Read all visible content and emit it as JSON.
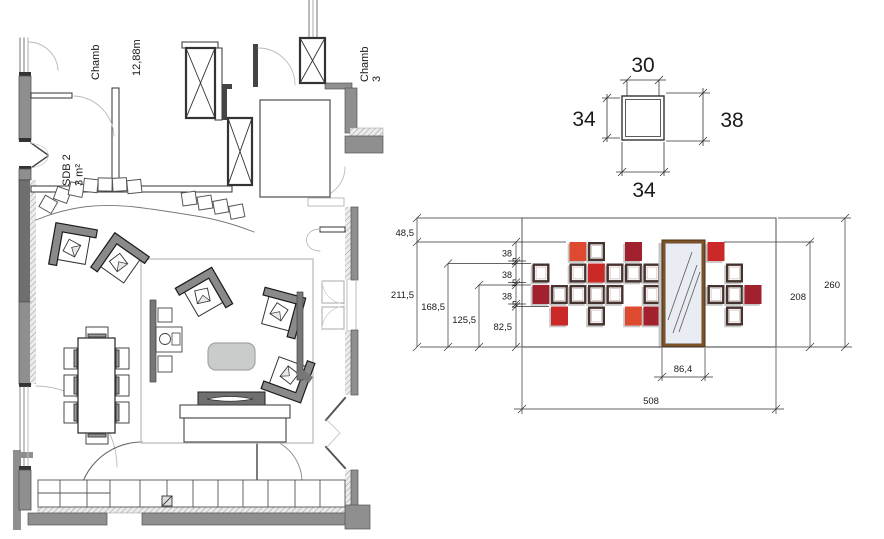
{
  "floor_plan": {
    "labels": {
      "bedroom_left": "Chamb",
      "bedroom_left_area": "12,88m",
      "bathroom": "SDB 2",
      "bathroom_area": "3 m²",
      "bedroom_right": "Chamb",
      "bedroom_right_number": "3"
    }
  },
  "frame_detail": {
    "width_top": "30",
    "height_left": "34",
    "height_right": "38",
    "width_bottom": "34"
  },
  "elevation": {
    "dim_48": "48,5",
    "dim_211": "211,5",
    "dim_168": "168,5",
    "dim_125": "125,5",
    "dim_82": "82,5",
    "stack": [
      {
        "v": "38"
      },
      {
        "v": "5"
      },
      {
        "v": "38"
      },
      {
        "v": "5"
      },
      {
        "v": "38"
      },
      {
        "v": "5"
      }
    ],
    "dim_208": "208",
    "dim_260": "260",
    "dim_mirror": "86,4",
    "dim_total": "508",
    "colors": {
      "orange": "#de4a2f",
      "red": "#ca2928",
      "dark_red": "#a2212f",
      "frame": "#46322f",
      "frame_inner": "#cbb9b3",
      "mirror_wood": "#7d5226",
      "glass": "#e9edf3",
      "shadow": "#c6c6c6"
    },
    "frames": [
      {
        "col": "C",
        "row": 1,
        "fill": "orange"
      },
      {
        "col": "D",
        "row": 1,
        "fill": "white"
      },
      {
        "col": "F",
        "row": 1,
        "fill": "dark_red"
      },
      {
        "col": "H",
        "row": 1,
        "fill": "red"
      },
      {
        "col": "A",
        "row": 2,
        "fill": "white"
      },
      {
        "col": "C",
        "row": 2,
        "fill": "white"
      },
      {
        "col": "D",
        "row": 2,
        "fill": "red"
      },
      {
        "col": "E",
        "row": 2,
        "fill": "white"
      },
      {
        "col": "F",
        "row": 2,
        "fill": "white"
      },
      {
        "col": "G",
        "row": 2,
        "fill": "white"
      },
      {
        "col": "I",
        "row": 2,
        "fill": "white"
      },
      {
        "col": "A",
        "row": 3,
        "fill": "dark_red"
      },
      {
        "col": "B",
        "row": 3,
        "fill": "white"
      },
      {
        "col": "C",
        "row": 3,
        "fill": "white"
      },
      {
        "col": "D",
        "row": 3,
        "fill": "white"
      },
      {
        "col": "E",
        "row": 3,
        "fill": "white"
      },
      {
        "col": "G",
        "row": 3,
        "fill": "white"
      },
      {
        "col": "H",
        "row": 3,
        "fill": "white"
      },
      {
        "col": "I",
        "row": 3,
        "fill": "white"
      },
      {
        "col": "J",
        "row": 3,
        "fill": "dark_red"
      },
      {
        "col": "B",
        "row": 4,
        "fill": "red"
      },
      {
        "col": "D",
        "row": 4,
        "fill": "white"
      },
      {
        "col": "F",
        "row": 4,
        "fill": "orange"
      },
      {
        "col": "G",
        "row": 4,
        "fill": "dark_red"
      },
      {
        "col": "I",
        "row": 4,
        "fill": "white"
      }
    ]
  }
}
